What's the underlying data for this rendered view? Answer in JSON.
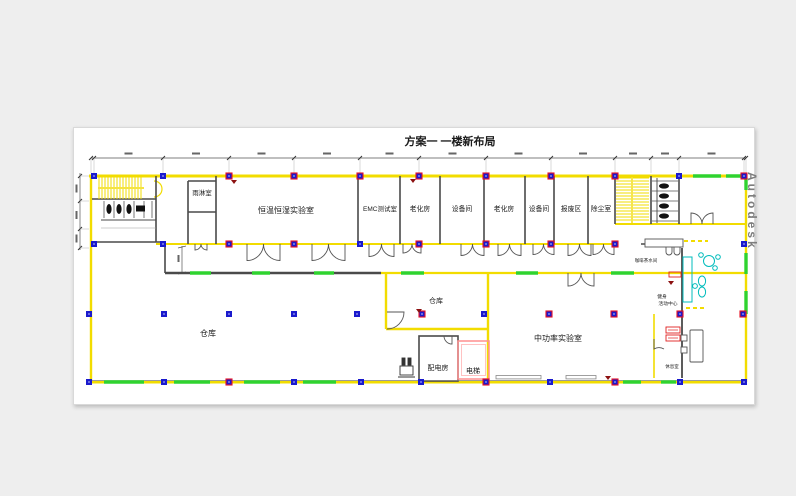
{
  "title": "方案一  一楼新布局",
  "watermark": "Autodesk",
  "rooms": {
    "rain_room": "雨淋室",
    "humidity_lab": "恒温恒湿实验室",
    "emc_test_room": "EMC测试室",
    "aging_room_1": "老化房",
    "equipment_room_1": "设备间",
    "aging_room_2": "老化房",
    "equipment_room_2": "设备间",
    "scrap_area": "报废区",
    "dust_removal_room": "除尘室",
    "warehouse_main": "仓库",
    "warehouse_small": "仓库",
    "mid_power_lab": "中功率实验室",
    "power_distribution_room": "配电房",
    "elevator": "电梯",
    "coffee_pantry": "咖啡茶水间",
    "fitness_center_line1": "健身",
    "fitness_center_line2": "活动中心",
    "rest_room": "休息室"
  },
  "colors": {
    "wall_yellow": "#f2dc00",
    "wall_dark": "#4a4a4a",
    "new_wall_green": "#2fd32f",
    "column_blue": "#1a1acd",
    "column_marked_red": "#e81123",
    "elevator_pink": "#ff8f8f",
    "furniture_cyan": "#00bcbc",
    "marker_dark_red": "#8c1111",
    "canvas_white": "#ffffff",
    "background_gray": "#eeeeee"
  }
}
